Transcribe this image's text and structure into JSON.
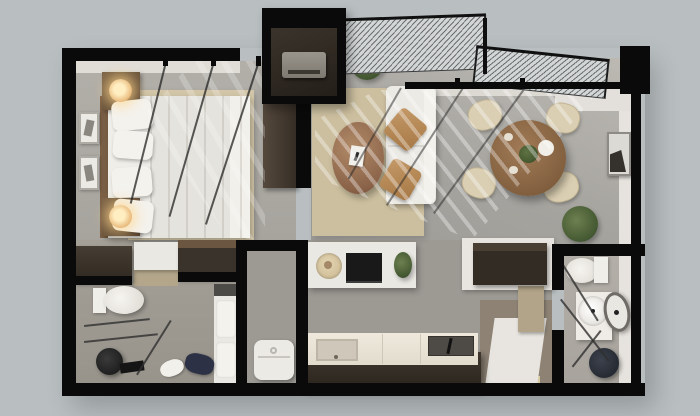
{
  "image": {
    "type": "3d-floor-plan-render",
    "view": "top-down axonometric",
    "subject": "one-bedroom apartment"
  },
  "palette": {
    "bg": "#b9bfc1",
    "wall": "#0a0a0a",
    "floorGray": "#a9a6a0",
    "floorBath": "#9f9b93",
    "floorTan": "#8d8274",
    "rug": "#d3c6a8",
    "rugLiving": "#ccbf9f",
    "whiteFurn": "#eae8e3",
    "woodDark": "#3a332b",
    "woodMid": "#6e573f",
    "woodTable": "#8a6a4c",
    "accentTan": "#b98d5f",
    "plantGreen": "#4e6238",
    "glassTint": "#d2d6d6"
  },
  "scene": {
    "rooms": [
      {
        "name": "bedroom",
        "furniture": [
          "double-bed",
          "pillows",
          "headboard",
          "nightstand-top",
          "nightstand-bottom",
          "glowing-lamps",
          "wall-frames",
          "tall-wardrobe",
          "area-rug"
        ]
      },
      {
        "name": "living-room",
        "furniture": [
          "white-sofa",
          "tan-accent-pillows",
          "oval-coffee-table",
          "book",
          "area-rug",
          "potted-plant"
        ]
      },
      {
        "name": "dining-area",
        "furniture": [
          "round-wood-table",
          "four-chairs",
          "centerpiece-plant",
          "bowl",
          "wall-art",
          "floor-plant"
        ]
      },
      {
        "name": "media-wall",
        "furniture": [
          "tv-console",
          "tv",
          "decor-plate",
          "small-plant"
        ]
      },
      {
        "name": "kitchenette",
        "furniture": [
          "counter",
          "sink",
          "cooktop",
          "utensil"
        ]
      },
      {
        "name": "bathroom-left",
        "furniture": [
          "toilet",
          "glass-shower-screen",
          "round-stool",
          "bench",
          "slippers",
          "sneakers",
          "storage-cabinet"
        ]
      },
      {
        "name": "bathroom-right",
        "furniture": [
          "toilet",
          "vanity-sink",
          "round-mirror",
          "dark-stool",
          "glass-partition",
          "side-cabinet"
        ]
      },
      {
        "name": "laundry-closet",
        "furniture": [
          "washing-machine"
        ]
      },
      {
        "name": "entry-vestibule",
        "furniture": [
          "hvac-unit"
        ]
      }
    ],
    "architecture": [
      "black-structural-walls",
      "stepped-skylight-glazing",
      "window-mullions",
      "sunlight-streaks"
    ]
  }
}
